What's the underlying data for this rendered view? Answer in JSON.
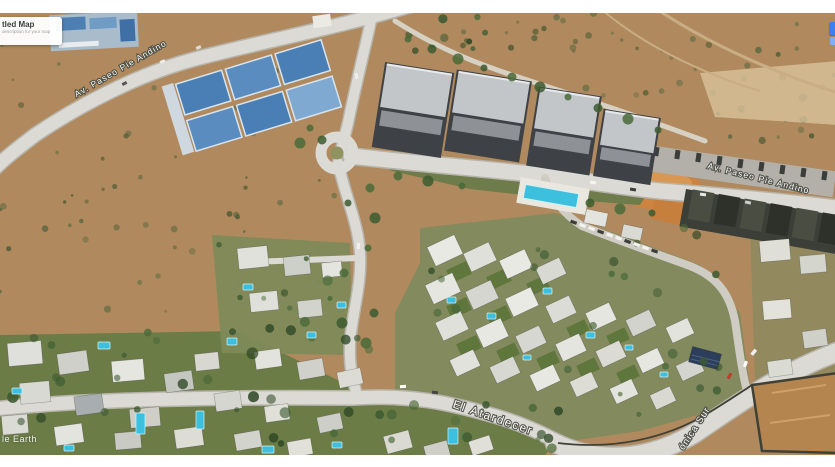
{
  "overlay_panel": {
    "title_fragment": "tled Map",
    "subtitle_fragment": "description for your map"
  },
  "watermark_fragment": "le Earth",
  "road_labels": {
    "pie_andino_west": "Av. Paseo Pie Andino",
    "pie_andino_east": "Av. Paseo Pie Andino",
    "el_atardecer": "El Atardecer",
    "sur_fragment": "ónica Sur"
  },
  "colors": {
    "road": "#dcdad4",
    "terrain_dirt": "#b08a5e",
    "residential_green": "#828a5e",
    "pool_cyan": "#3cc0de",
    "label_white": "#ffffff",
    "label_halo": "#4c4e45",
    "panel_title": "#3c4043",
    "panel_subtitle": "#9aa0a6",
    "ui_chip_blue": "#3d7ff0",
    "orange_dirt": "#cd8440"
  }
}
